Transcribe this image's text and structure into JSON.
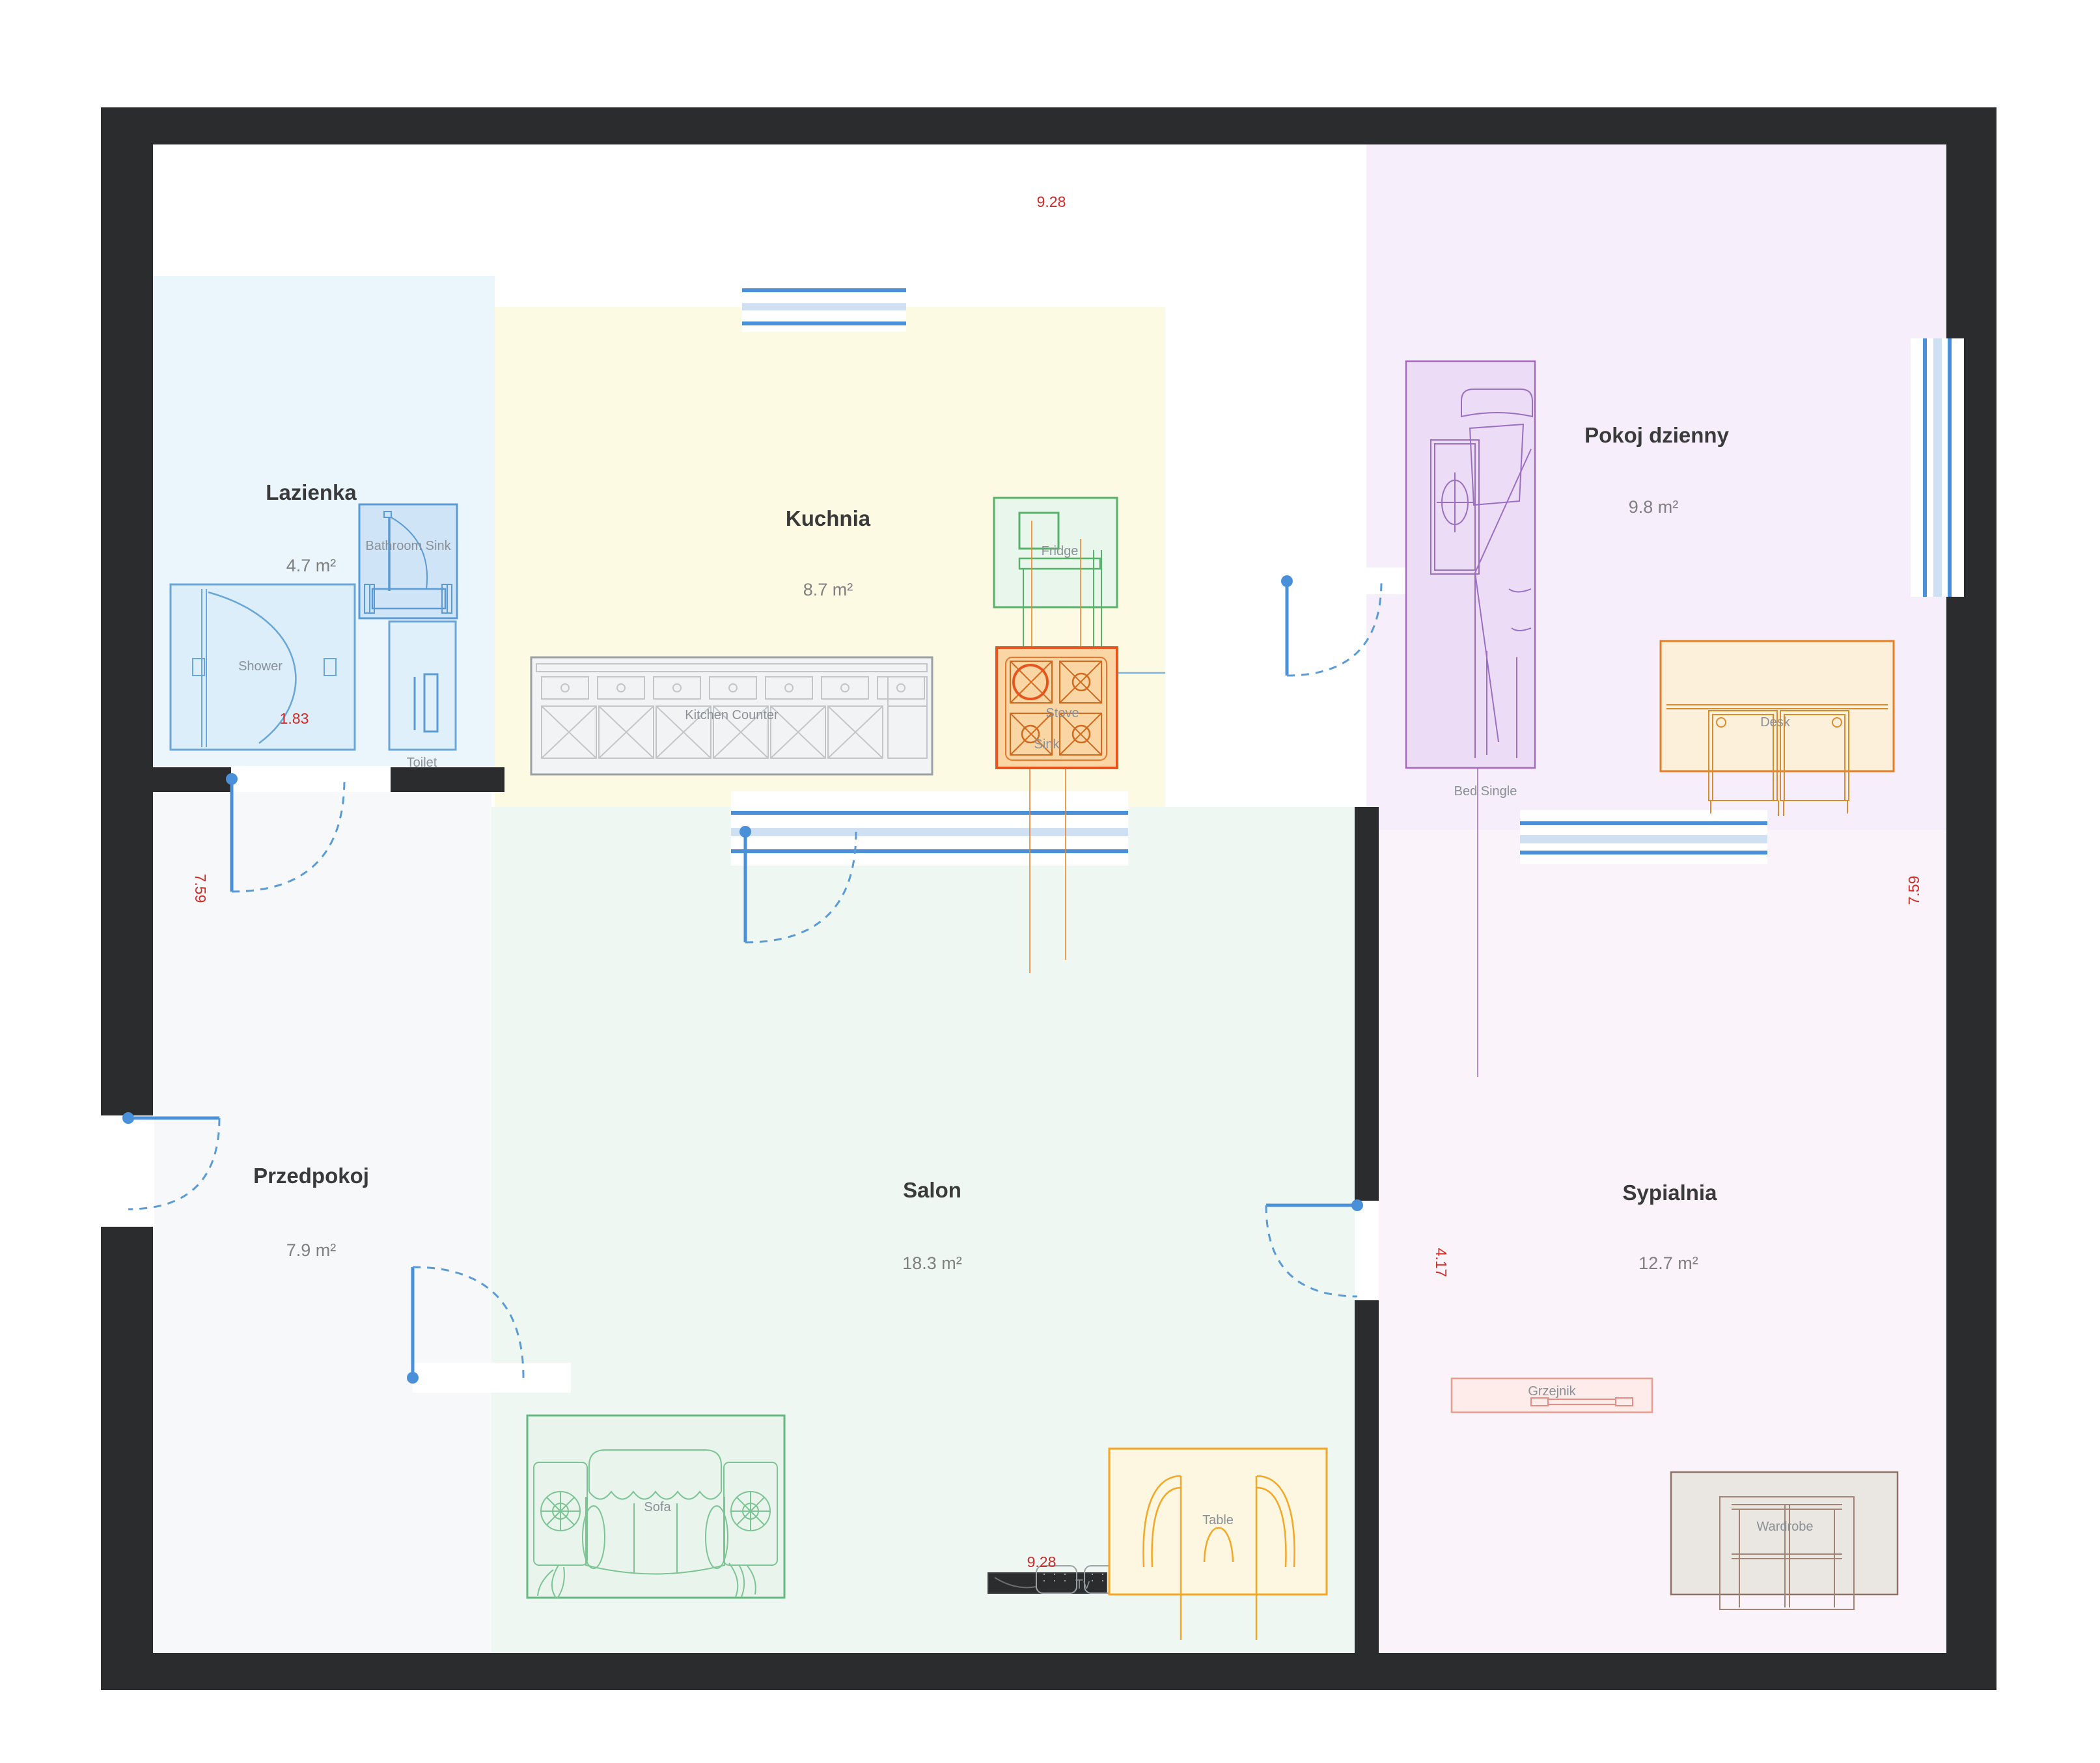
{
  "rooms": {
    "lazienka": {
      "name": "Lazienka",
      "area": "4.7 m²"
    },
    "kuchnia": {
      "name": "Kuchnia",
      "area": "8.7 m²"
    },
    "przedpokoj": {
      "name": "Przedpokoj",
      "area": "7.9 m²"
    },
    "salon": {
      "name": "Salon",
      "area": "18.3 m²"
    },
    "pokoj_dzienny": {
      "name": "Pokoj dzienny",
      "area": "9.8 m²"
    },
    "sypialnia": {
      "name": "Sypialnia",
      "area": "12.7 m²"
    }
  },
  "furniture": {
    "shower": "Shower",
    "bathroom_sink": "Bathroom Sink",
    "toilet": "Toilet",
    "kitchen_counter": "Kitchen Counter",
    "fridge": "Fridge",
    "stove": "Stove",
    "sink": "Sink",
    "sofa": "Sofa",
    "tv": "Tv",
    "table": "Table",
    "bed": "Bed Single",
    "desk": "Desk",
    "radiator": "Grzejnik",
    "wardrobe": "Wardrobe"
  },
  "dimensions": {
    "top": "9.28",
    "bottom": "9.28",
    "left": "7.59",
    "right": "7.59",
    "shower_width": "1.83",
    "bedroom_entry": "4.17"
  },
  "colors": {
    "wall": "#2a2c2d",
    "accent_blue": "#4a90d9",
    "dimension_red": "#cf2b27",
    "lazienka_fill": "#ebf5fc",
    "kuchnia_fill": "#fdfae3",
    "przedpokoj_fill": "#f7f8f9",
    "salon_fill": "#eff7f2",
    "pokoj_dzienny_fill": "#f6eefa",
    "sypialnia_fill": "#faf3f9",
    "fridge_accent": "#57b269",
    "stove_accent": "#e8541e",
    "table_accent": "#f5a623",
    "sofa_accent": "#63ba80",
    "bed_accent": "#a569bd",
    "desk_accent": "#e67e22",
    "radiator_accent": "#ec9b8f",
    "wardrobe_accent": "#8d7265"
  }
}
